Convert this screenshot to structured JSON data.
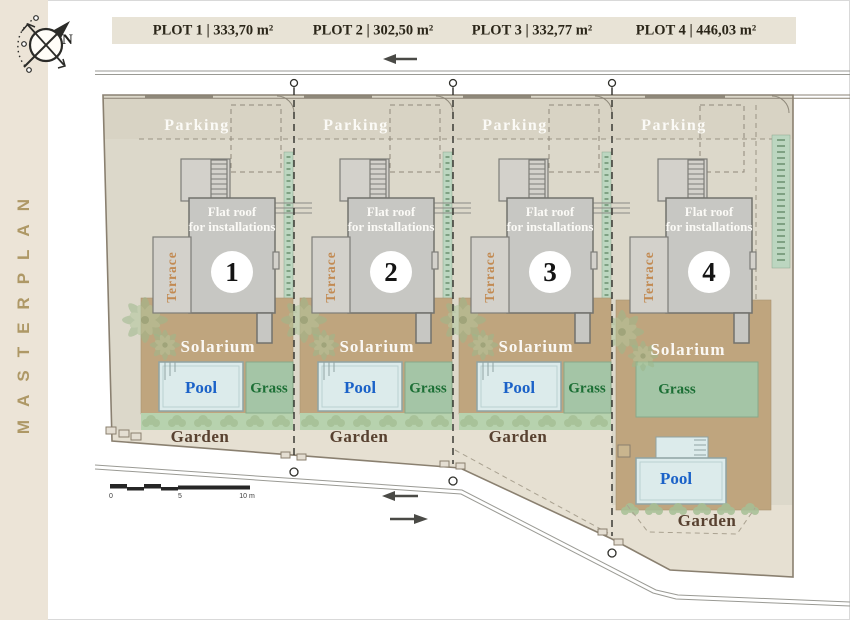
{
  "sidebar": {
    "title": "MASTERPLAN"
  },
  "compass": {
    "north": "N"
  },
  "header": {
    "plot_labels": [
      "PLOT 1 | 333,70 m²",
      "PLOT 2 | 302,50 m²",
      "PLOT 3 | 332,77 m²",
      "PLOT 4 | 446,03 m²"
    ]
  },
  "plots": [
    {
      "number": "1",
      "parking": "Parking",
      "flat_roof_line1": "Flat roof",
      "flat_roof_line2": "for installations",
      "terrace": "Terrace",
      "solarium": "Solarium",
      "pool": "Pool",
      "grass": "Grass",
      "garden": "Garden"
    },
    {
      "number": "2",
      "parking": "Parking",
      "flat_roof_line1": "Flat roof",
      "flat_roof_line2": "for installations",
      "terrace": "Terrace",
      "solarium": "Solarium",
      "pool": "Pool",
      "grass": "Grass",
      "garden": "Garden"
    },
    {
      "number": "3",
      "parking": "Parking",
      "flat_roof_line1": "Flat roof",
      "flat_roof_line2": "for installations",
      "terrace": "Terrace",
      "solarium": "Solarium",
      "pool": "Pool",
      "grass": "Grass",
      "garden": "Garden"
    },
    {
      "number": "4",
      "parking": "Parking",
      "flat_roof_line1": "Flat roof",
      "flat_roof_line2": "for installations",
      "terrace": "Terrace",
      "solarium": "Solarium",
      "pool": "Pool",
      "grass": "Grass",
      "garden": "Garden"
    }
  ],
  "scale_bar": {
    "zero": "0",
    "five": "5",
    "ten": "10 m"
  },
  "colors": {
    "sidebar_beige": "#ece4d7",
    "title_gold": "#ae9866",
    "header_strip": "#e8e3d6",
    "ground": "#dcd8ca",
    "parking_zone": "#d5d1c2",
    "building_gray": "#c7c7c3",
    "solarium_tan": "#bfa57e",
    "pool_fill": "#dcebeb",
    "grass_green": "#a4c5a6",
    "garden_band": "#b7d2ae",
    "pool_text": "#1b62c8",
    "grass_text": "#1c6f35",
    "garden_text": "#584130",
    "terrace_text": "#c28a52"
  }
}
